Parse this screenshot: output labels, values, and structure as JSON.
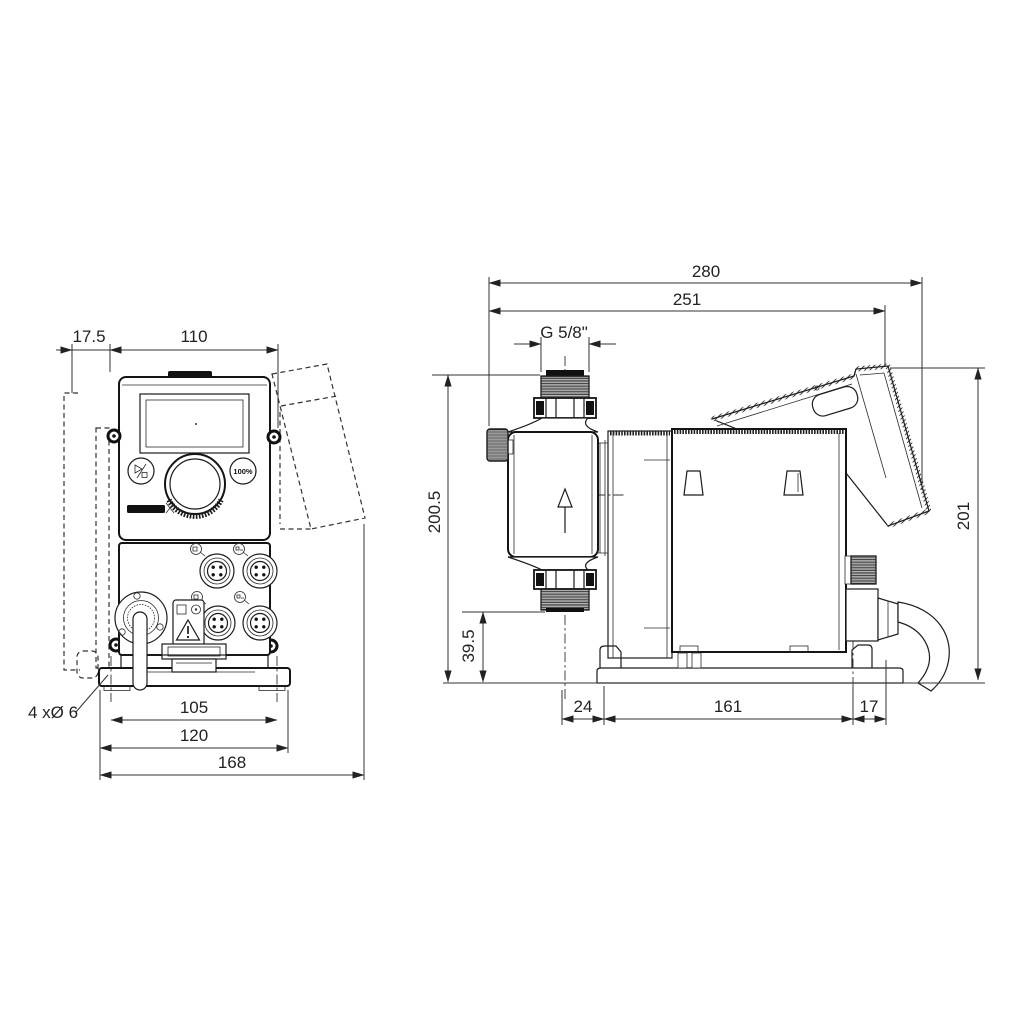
{
  "drawing": {
    "colors": {
      "background": "#ffffff",
      "line": "#1c1c1c",
      "dimension": "#333333"
    },
    "front_view": {
      "dims": {
        "bracket_offset": "17.5",
        "housing_width": "110",
        "hole_spacing": "105",
        "plate_width": "120",
        "total_width": "168",
        "mounting_holes": "4 xØ 6"
      },
      "panel": {
        "boost_button_label": "100%"
      }
    },
    "side_view": {
      "dims": {
        "total_depth": "280",
        "body_depth": "251",
        "connection_thread": "G 5/8\"",
        "height_over_valve": "200.5",
        "valve_clearance": "39.5",
        "head_overhang": "24",
        "base_depth": "161",
        "rear_overhang": "17",
        "total_height": "201"
      }
    }
  }
}
